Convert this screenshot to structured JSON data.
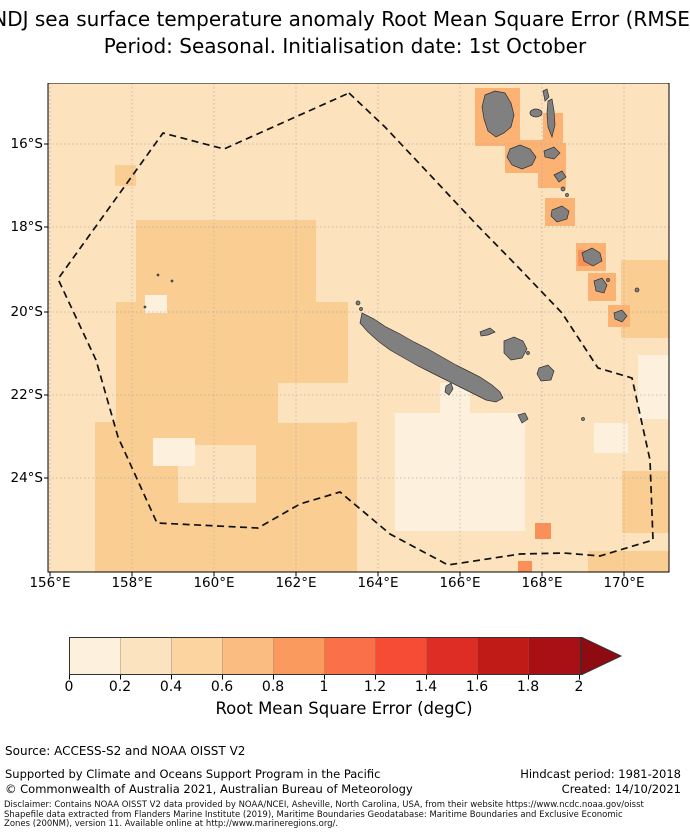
{
  "title": {
    "line1": "NDJ sea surface temperature anomaly Root Mean Square Error (RMSE)",
    "line2": "Period: Seasonal. Initialisation date: 1st October"
  },
  "axes": {
    "x_ticks": [
      "156°E",
      "158°E",
      "160°E",
      "162°E",
      "164°E",
      "166°E",
      "168°E",
      "170°E"
    ],
    "y_ticks": [
      "16°S",
      "18°S",
      "20°S",
      "22°S",
      "24°S"
    ]
  },
  "colorbar": {
    "label": "Root Mean Square Error (degC)",
    "ticks": [
      "0",
      "0.2",
      "0.4",
      "0.6",
      "0.8",
      "1",
      "1.2",
      "1.4",
      "1.6",
      "1.8",
      "2"
    ],
    "colors": [
      "#FDF0DC",
      "#FCE3C0",
      "#FBD4A0",
      "#FBBC82",
      "#FA9A5F",
      "#FA7048",
      "#F64B35",
      "#DD2D24",
      "#C11B17",
      "#A91016"
    ],
    "arrow_color": "#8E0B12"
  },
  "palette": {
    "ocean_low": "#FDF0DC",
    "ocean_base": "#FDE2BE",
    "ocean_mid": "#FACD92",
    "ocean_high": "#FBB273",
    "ocean_higher": "#FA9058",
    "island": "#808080",
    "island_outline": "#2F2F2F",
    "eez": "#111111",
    "grid": "#AAAAAA",
    "axis": "#000000"
  },
  "footer": {
    "source": "Source: ACCESS-S2 and NOAA OISST V2",
    "supported": "Supported by Climate and Oceans Support Program in the Pacific",
    "copyright": "© Commonwealth of Australia 2021, Australian Bureau of Meteorology",
    "hindcast": "Hindcast period: 1981-2018",
    "created": "Created: 14/10/2021"
  },
  "disclaimer": {
    "line1": "Disclaimer: Contains NOAA OISST V2 data provided by NOAA/NCEI, Asheville, North Carolina, USA, from their website https://www.ncdc.noaa.gov/oisst",
    "line2": "Shapefile data extracted from Flanders Marine Institute (2019), Maritime Boundaries Geodatabase: Maritime Boundaries and Exclusive Economic",
    "line3": "Zones (200NM), version 11. Available online at http://www.marineregions.org/."
  },
  "chart_data": {
    "type": "heatmap",
    "title": "NDJ sea surface temperature anomaly Root Mean Square Error (RMSE)",
    "subtitle": "Period: Seasonal. Initialisation date: 1st October",
    "xlabel": "Longitude",
    "ylabel": "Latitude",
    "x_tick_labels": [
      "156°E",
      "158°E",
      "160°E",
      "162°E",
      "164°E",
      "166°E",
      "168°E",
      "170°E"
    ],
    "y_tick_labels": [
      "16°S",
      "18°S",
      "20°S",
      "22°S",
      "24°S"
    ],
    "lon_range_deg_e": [
      156,
      171
    ],
    "lat_range_deg_s": [
      14.6,
      25.7
    ],
    "grid": true,
    "colorbar": {
      "label": "Root Mean Square Error (degC)",
      "ticks": [
        0,
        0.2,
        0.4,
        0.6,
        0.8,
        1,
        1.2,
        1.4,
        1.6,
        1.8,
        2
      ],
      "range": [
        0,
        2
      ],
      "extend": "max",
      "n_bins": 10
    },
    "values_summary": [
      {
        "region": "most of open ocean in domain",
        "rmse_degC": "0.2-0.4"
      },
      {
        "region": "west-central band 157-162E, 18-25S and right edge near 170E",
        "rmse_degC": "0.4-0.6"
      },
      {
        "region": "cells hugging Vanuatu islands (Santo, Malekula, Efate, Erromango, Tanna, Aneityum)",
        "rmse_degC": "0.6-0.8"
      },
      {
        "region": "isolated cells near Erromango and south of Loyalty Islands",
        "rmse_degC": "0.8-1.0"
      },
      {
        "region": "southeast of New Caledonia and scattered patches",
        "rmse_degC": "0.0-0.2"
      }
    ],
    "overlays": [
      "dashed EEZ boundary polygon",
      "land shown grey: New Caledonia (Grande Terre, Loyalty Islands, Île des Pins) and Vanuatu island chain"
    ]
  }
}
